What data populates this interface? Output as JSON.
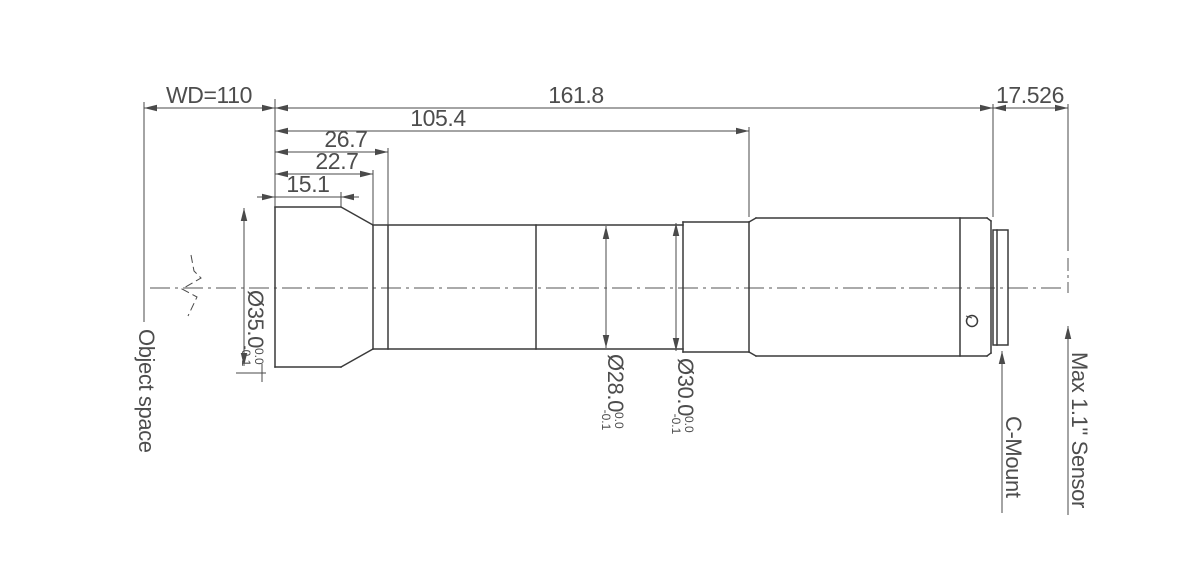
{
  "drawing": {
    "linear_dimensions": {
      "working_distance": "WD=110",
      "total_barrel_length": "161.8",
      "flange_to_sensor": "17.526",
      "front_to_rear_barrel": "105.4",
      "front_to_ring": "26.7",
      "front_to_taper_end": "22.7",
      "front_face_length": "15.1"
    },
    "diameter_dimensions": {
      "front": {
        "value": "Ø35.0",
        "tol_upper": "0.0",
        "tol_lower": "-0.1"
      },
      "mid": {
        "value": "Ø28.0",
        "tol_upper": "0.0",
        "tol_lower": "-0.1"
      },
      "rear": {
        "value": "Ø30.0",
        "tol_upper": "0.0",
        "tol_lower": "-0.1"
      }
    },
    "annotations": {
      "object_space": "Object space",
      "c_mount": "C-Mount",
      "sensor": "Max 1.1\" Sensor"
    },
    "colors": {
      "outline": "#3a3a3a",
      "dimension": "#4a4a4a",
      "text": "#4d4d4d",
      "background": "#ffffff"
    }
  }
}
